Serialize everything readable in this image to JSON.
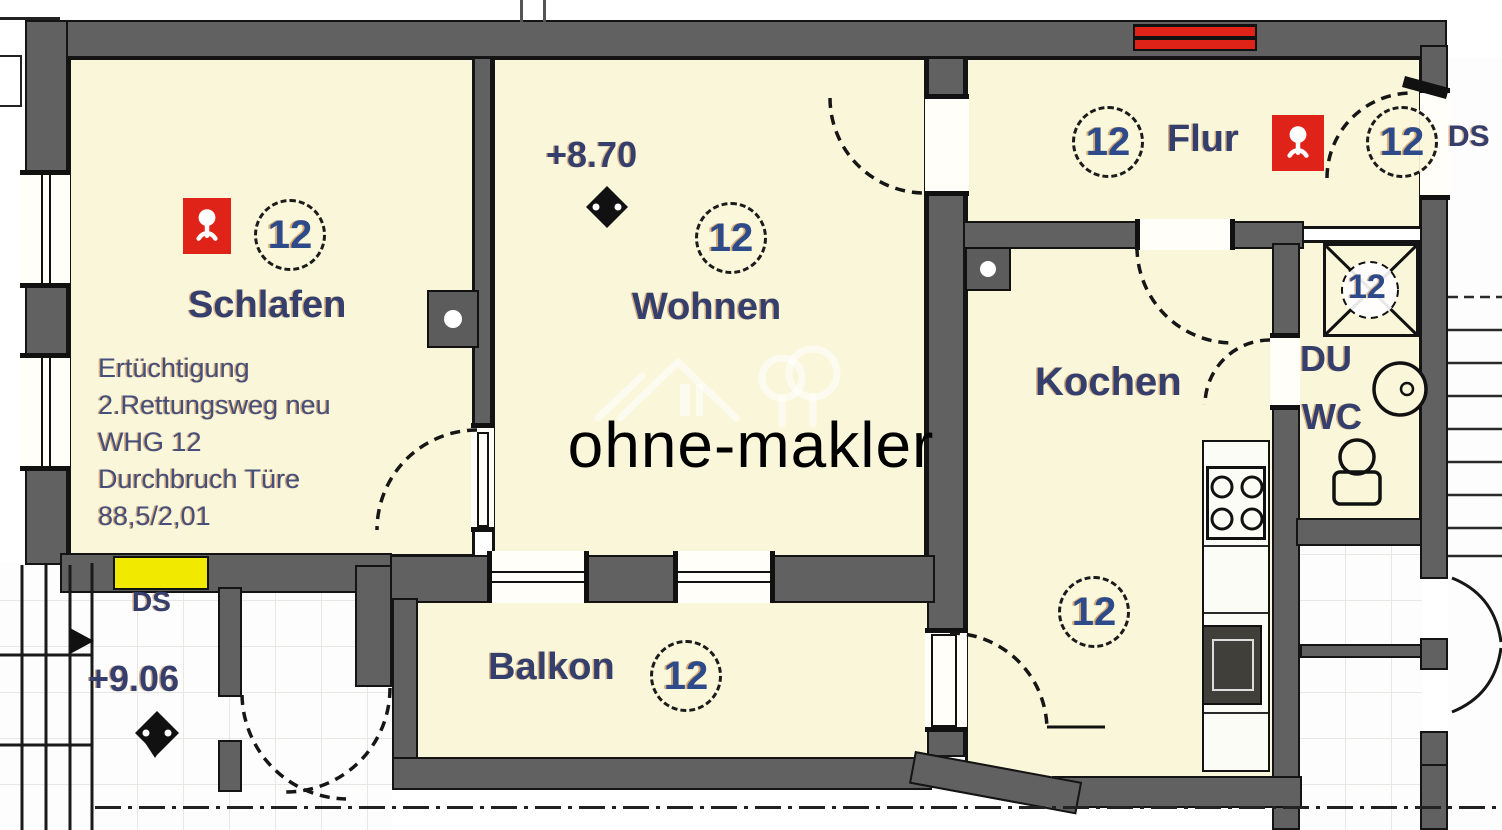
{
  "colors": {
    "room_fill": "#faf6da",
    "wall_gray": "#616161",
    "outline_black": "#141414",
    "accent_red": "#e02318",
    "highlight_yellow": "#f2e900",
    "label_navy": "#343f6d",
    "watermark_white": "rgba(255,255,255,0.62)"
  },
  "rooms": {
    "schlafen": {
      "label": "Schlafen",
      "number": "12"
    },
    "wohnen": {
      "label": "Wohnen",
      "number": "12"
    },
    "flur": {
      "label": "Flur",
      "number": "12"
    },
    "kochen": {
      "label": "Kochen",
      "number": "12"
    },
    "balkon": {
      "label": "Balkon",
      "number": "12"
    },
    "du_wc": {
      "label_du": "DU",
      "label_wc": "WC"
    },
    "entry": {
      "number": "12"
    },
    "shaft": {
      "number": "12"
    }
  },
  "annotations": {
    "elevation_wohnen": "+8.70",
    "elevation_stair": "+9.06",
    "ds_stair_left": "DS",
    "ds_stair_right": "DS",
    "note_line1": "Ertüchtigung",
    "note_line2": "2.Rettungsweg neu",
    "note_line3": "WHG 12",
    "note_line4": "Durchbruch Türe",
    "note_line5": "88,5/2,01"
  },
  "icons": {
    "smoke_detector": "red square with white sprinkler glyph",
    "elevation_marker": "black diamond level marker",
    "renovation_marker": "red double bar in wall"
  },
  "watermark": {
    "text": "ohne-makler"
  }
}
